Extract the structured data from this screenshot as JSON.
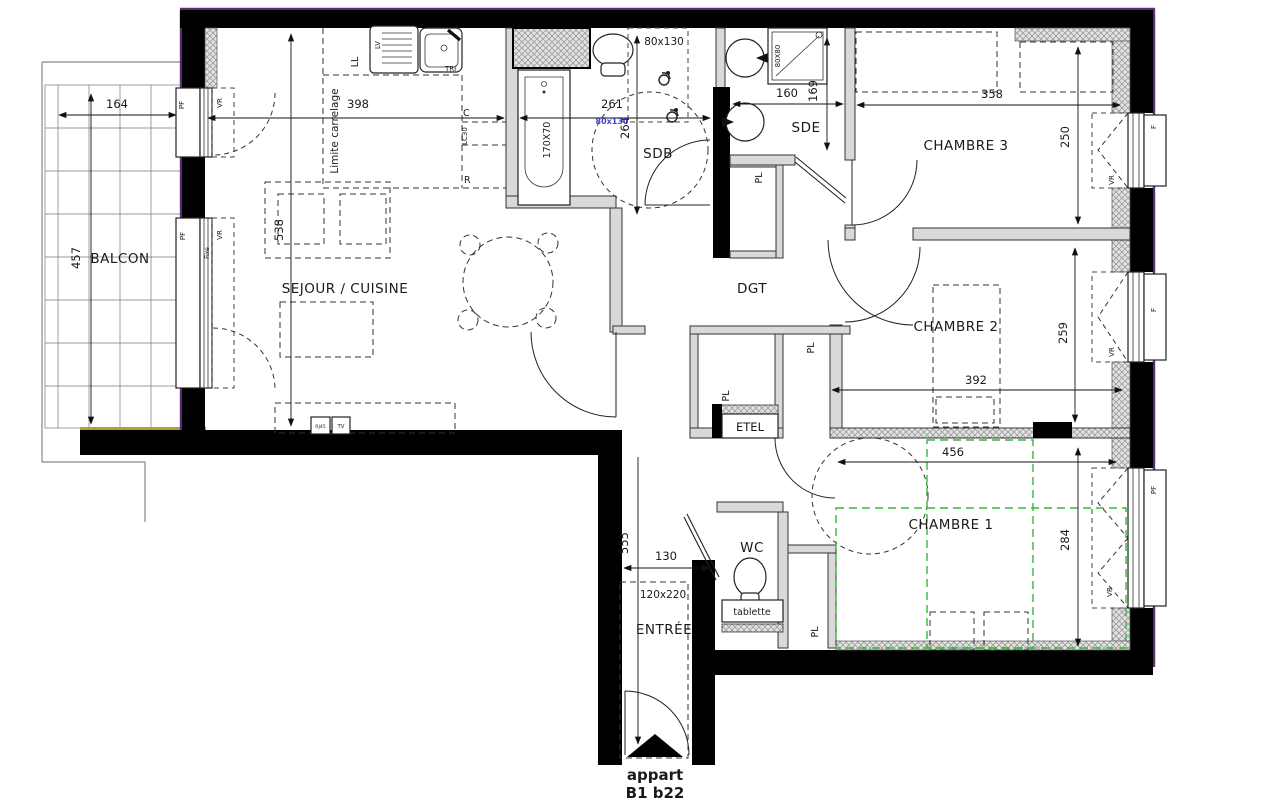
{
  "plan": {
    "rooms": {
      "balcon": "BALCON",
      "sejour": "SEJOUR / CUISINE",
      "sdb": "SDB",
      "sde": "SDE",
      "chambre3": "CHAMBRE 3",
      "chambre2": "CHAMBRE 2",
      "chambre1": "CHAMBRE 1",
      "dgt": "DGT",
      "wc": "WC",
      "entree": "ENTRÉE"
    },
    "dimensions": {
      "balcony_width": "164",
      "balcony_depth": "457",
      "kitchen_width": "398",
      "sejour_depth": "538",
      "sdb_width": "261",
      "sdb_depth": "264",
      "sdb_door": "80x130",
      "sdb_door_small": "80x130",
      "bathtub": "170X70",
      "shower": "80X80",
      "sde_width": "160",
      "sde_depth": "169",
      "chambre3_width": "358",
      "chambre3_depth": "250",
      "chambre2_width": "392",
      "chambre2_depth": "259",
      "chambre1_width": "456",
      "chambre1_depth": "284",
      "entree_depth": "555",
      "entree_width": "130",
      "entry_door": "120x220"
    },
    "annotations": {
      "limite_carrelage": "Limite carrelage",
      "etel": "ETEL",
      "tablette": "tablette",
      "placard": "PL",
      "window_pf": "PF",
      "window_vr": "VR",
      "window_f": "F",
      "window_fixe": "Fixe",
      "washer": "LL",
      "dishwasher": "LV",
      "tri": "TRI",
      "cooker": "C",
      "lc30": "LC30",
      "fridge": "R",
      "rj45": "RJ45",
      "tv": "TV"
    },
    "footer": {
      "line1": "appart",
      "line2": "B1 b22"
    },
    "colors": {
      "wall": "#000000",
      "exterior_outline": "#5e2b77",
      "balcony_edge": "#b3a12c",
      "accessible_zone": "#33bb33",
      "dim_blue": "#4444cc"
    }
  }
}
